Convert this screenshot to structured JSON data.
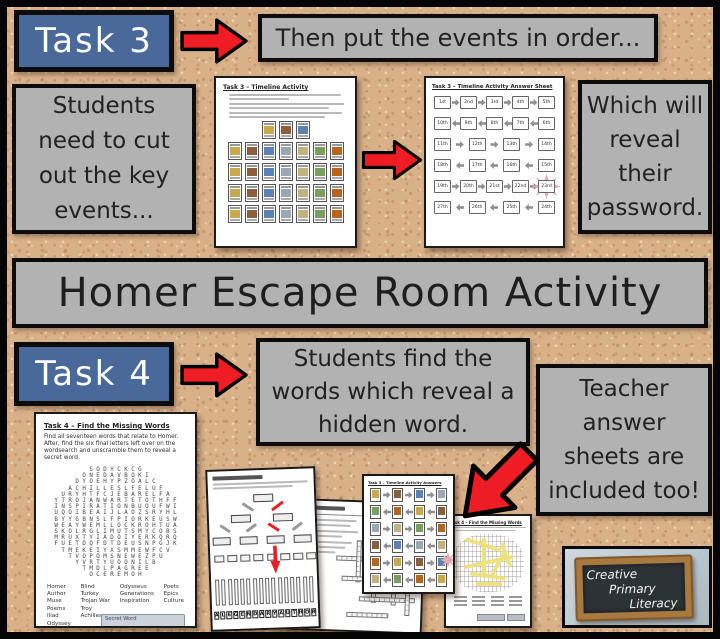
{
  "colors": {
    "cork": "#d9b189",
    "panel_gray": "#b2b2b2",
    "task_blue": "#49699b",
    "arrow_red": "#ee1c23",
    "starburst_pink": "#e8a8b0",
    "highlight_yellow": "#ede07c",
    "badge_orange": "#dd9a3e",
    "chalk_frame": "#a97a3f",
    "chalk_slate": "#2c3337"
  },
  "banner": {
    "title": "Homer Escape Room Activity"
  },
  "task3": {
    "label": "Task 3",
    "then_note": "Then put the events in order...",
    "students_note": "Students need to cut out the key events...",
    "password_note": "Which will reveal their password.",
    "worksheet": {
      "title": "Task 3 – Timeline Activity",
      "card_rows": [
        3,
        7,
        7,
        7,
        7
      ]
    },
    "answer_sheet": {
      "title": "Task 3 – Timeline Activity Answer Sheet",
      "rows": [
        {
          "dir": "right",
          "cells": [
            "1st",
            "2nd",
            "3rd",
            "4th",
            "5th"
          ]
        },
        {
          "dir": "left",
          "cells": [
            "10th",
            "9th",
            "8th",
            "7th",
            "6th"
          ]
        },
        {
          "dir": "right",
          "cells": [
            "11th",
            "12th",
            "13th",
            "14th"
          ]
        },
        {
          "dir": "left",
          "cells": [
            "18th",
            "17th",
            "16th",
            "15th"
          ]
        },
        {
          "dir": "right",
          "cells": [
            "19th",
            "20th",
            "21st",
            "22nd",
            "23rd"
          ],
          "highlight": "23rd"
        },
        {
          "dir": "left",
          "cells": [
            "27th",
            "26th",
            "25th",
            "24th"
          ]
        }
      ]
    },
    "picture_answers": {
      "title": "Task 3 – Timeline Activity Answers",
      "card_rows": [
        4,
        4,
        4,
        4,
        4,
        4
      ]
    }
  },
  "task4": {
    "label": "Task 4",
    "find_note": "Students find the words which reveal a hidden word.",
    "teacher_note": "Teacher answer sheets are included too!",
    "worksheet": {
      "title": "Task 4 – Find the Missing Words",
      "instructions": "Find all seventeen words that relate to Homer. After, find the six final letters left over on the wordsearch and unscramble them to reveal a secret word.",
      "grid_rows": [
        "SODYCKCG",
        "ONEDAVBOKI",
        "DYOEHYPZOALC",
        "ACHILLESLFELUF",
        "URYHTFCJEBARELFA",
        "YTROJANWARTETOTHFF",
        "INSPIRATIONBUOUFWI",
        "UQOIBEAIJLAOZSRYHL",
        "BYYGBNSLFPIORKEUSW",
        "WEAYWEMLLOCKROHTUA",
        "SKOLRGLIMUTSMYCOBS",
        "MRUXTYIADOIYERKQRQ",
        "FUETDQFDTDEUSNPGJK",
        "TMEKEIYXSMMEWFCV",
        "TVOPOMSNEWEZPU",
        "YVRTYUOONILB",
        "TMDLPAGREE",
        "OCEREMOH"
      ],
      "word_columns": [
        [
          "Homer",
          "Author",
          "Muse",
          "Poems",
          "Iliad",
          "Odyssey"
        ],
        [
          "Blind",
          "Turkey",
          "Trojan War",
          "Troy",
          "Achilles"
        ],
        [
          "Odysseus",
          "Generations",
          "Inspiration"
        ],
        [
          "Poets",
          "Epics",
          "Culture"
        ]
      ],
      "secret_label": "Secret Word"
    },
    "flow_letters": [
      "A",
      "L",
      "E",
      "G",
      "E",
      "N",
      "D",
      "A",
      "R",
      "Y",
      "A",
      "U",
      "T",
      "H",
      "O",
      "R"
    ],
    "answer_badge": "ANSWER SHEET",
    "answer_search_title": "Task 4 – Find the Missing Words"
  },
  "logo": {
    "lines": [
      "Creative",
      "Primary",
      "Literacy"
    ]
  }
}
